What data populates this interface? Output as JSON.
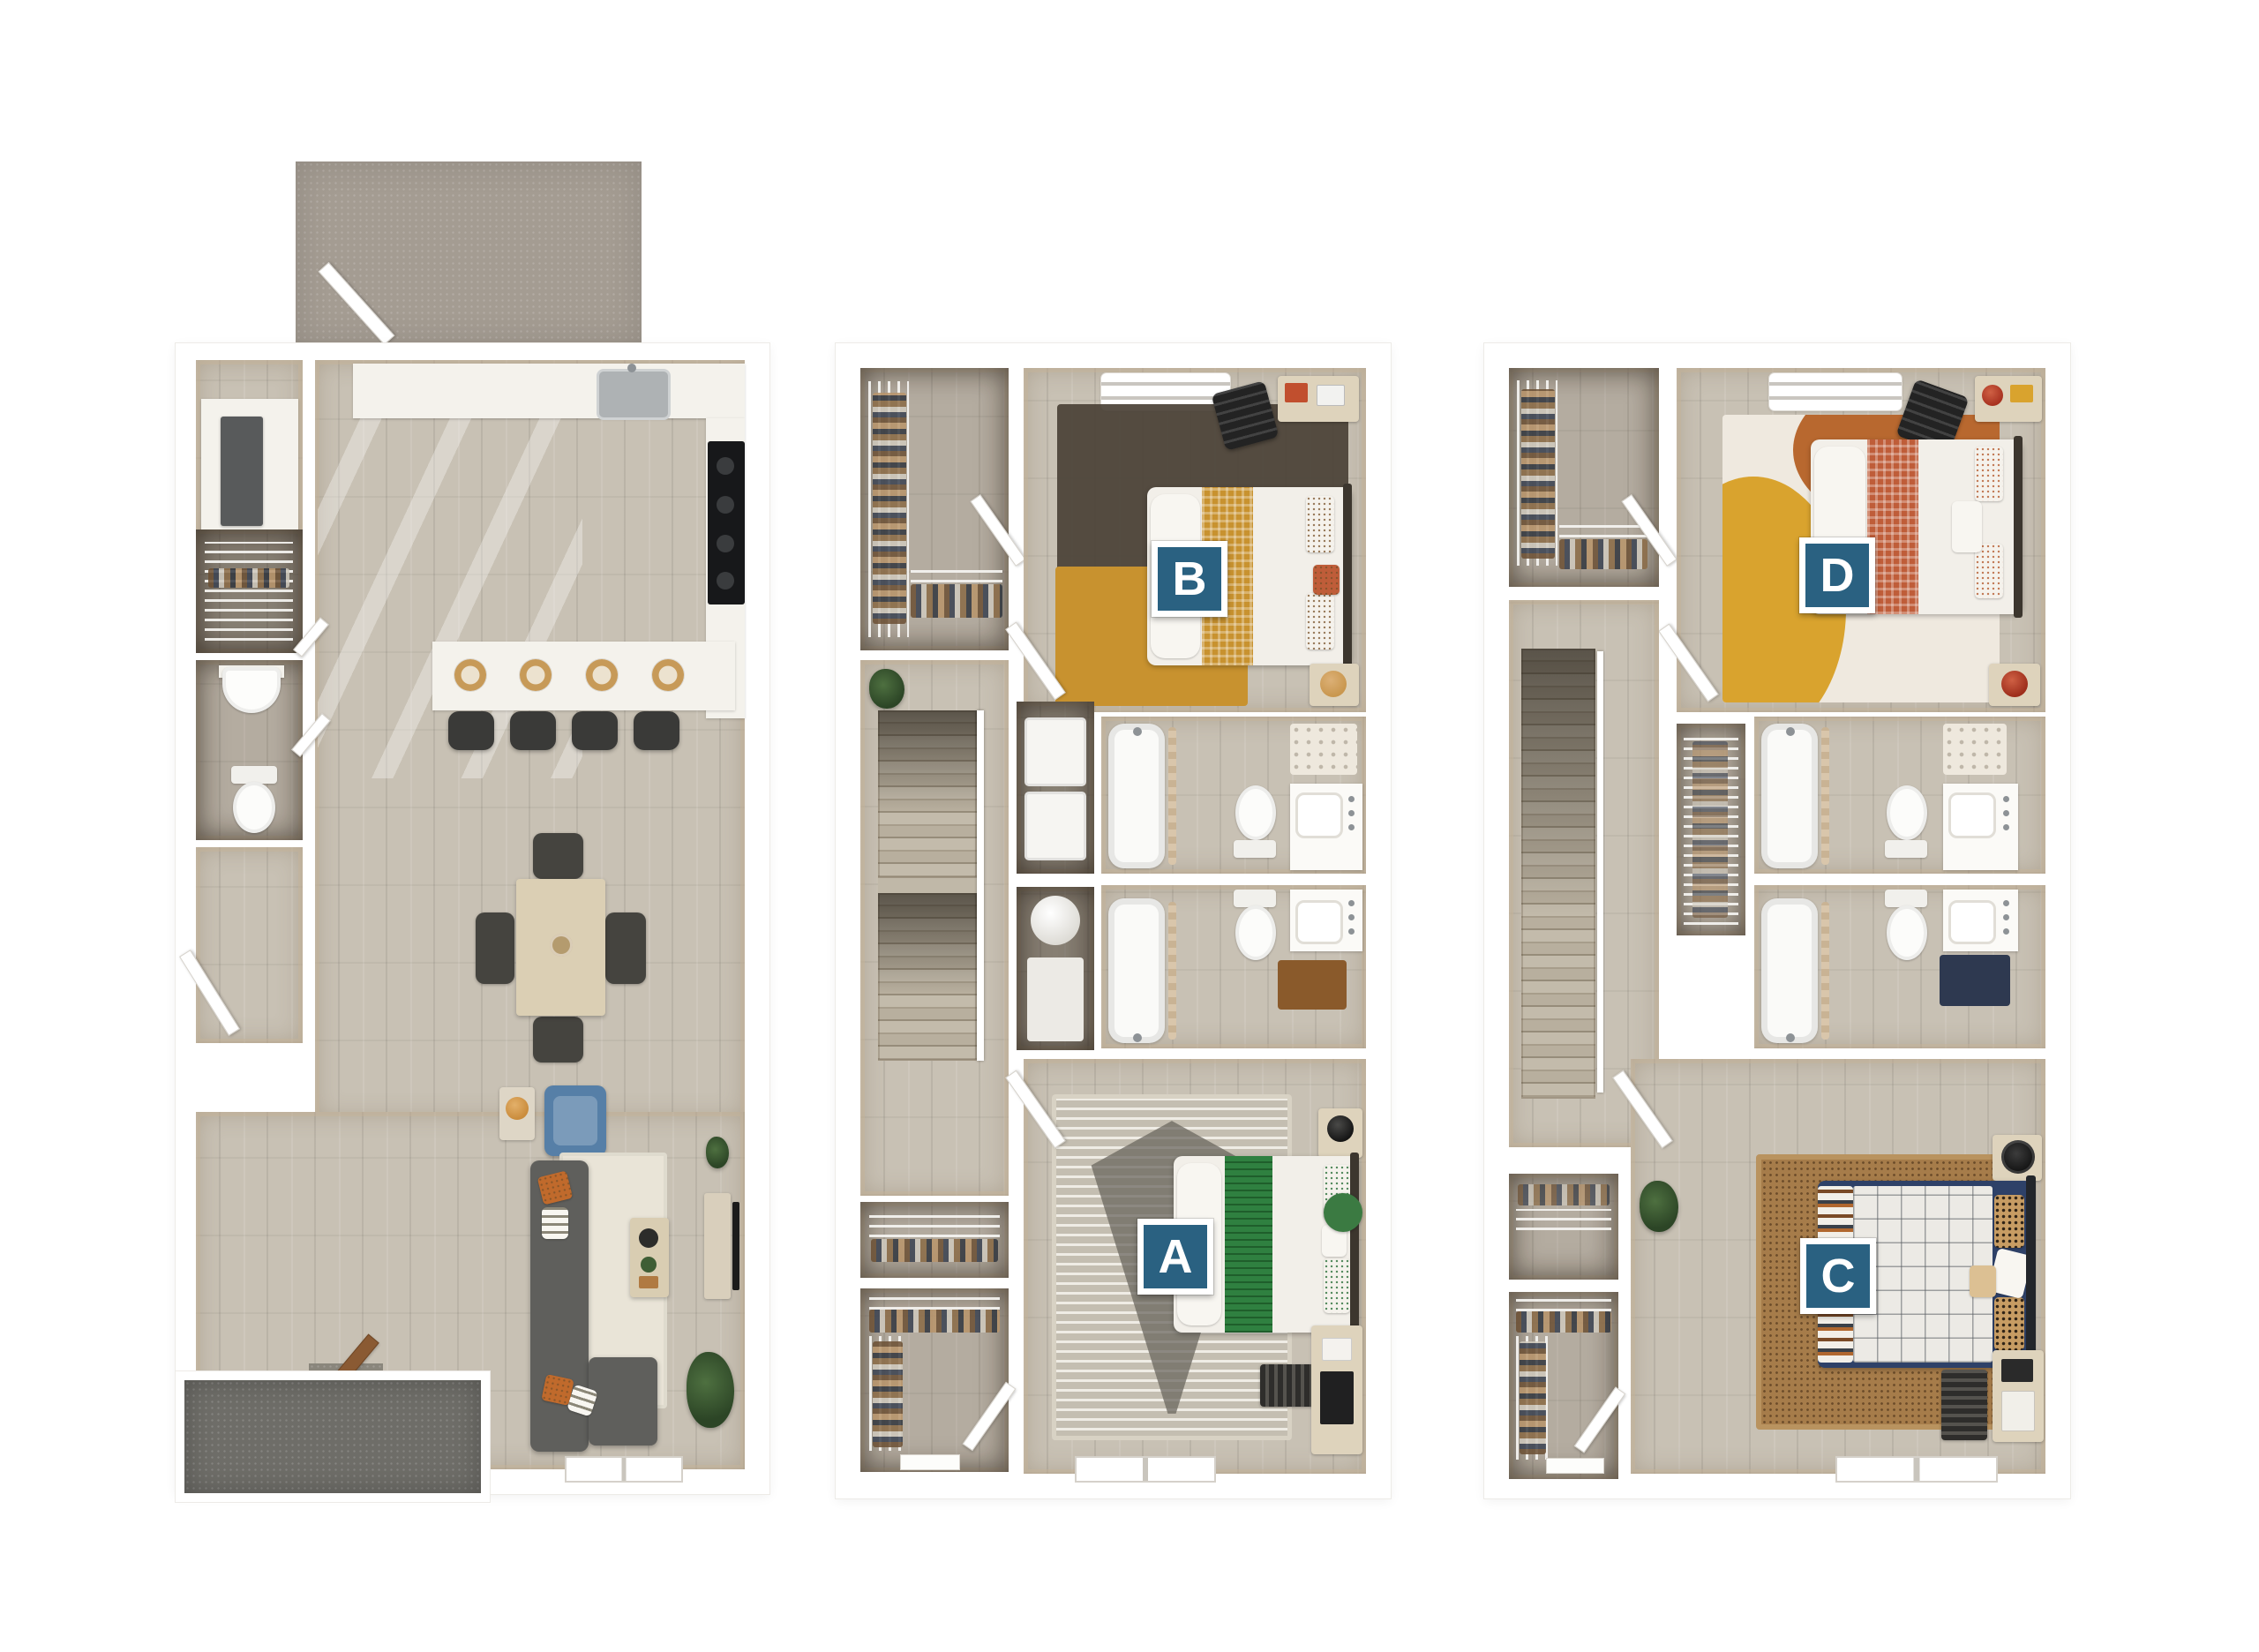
{
  "badges": {
    "a": "A",
    "b": "B",
    "c": "C",
    "d": "D"
  },
  "colors": {
    "badge": "#2a6181",
    "badgeBorder": "#ffffff",
    "floor": "#c8c1b4",
    "patio": "#a49c92",
    "stoop": "#6e6d68",
    "mustard": "#c8922f",
    "green": "#2f8040",
    "rust": "#bf5d39",
    "navy": "#2e4168",
    "sofa": "#5f5f5c",
    "chairBlue": "#567fa7"
  }
}
